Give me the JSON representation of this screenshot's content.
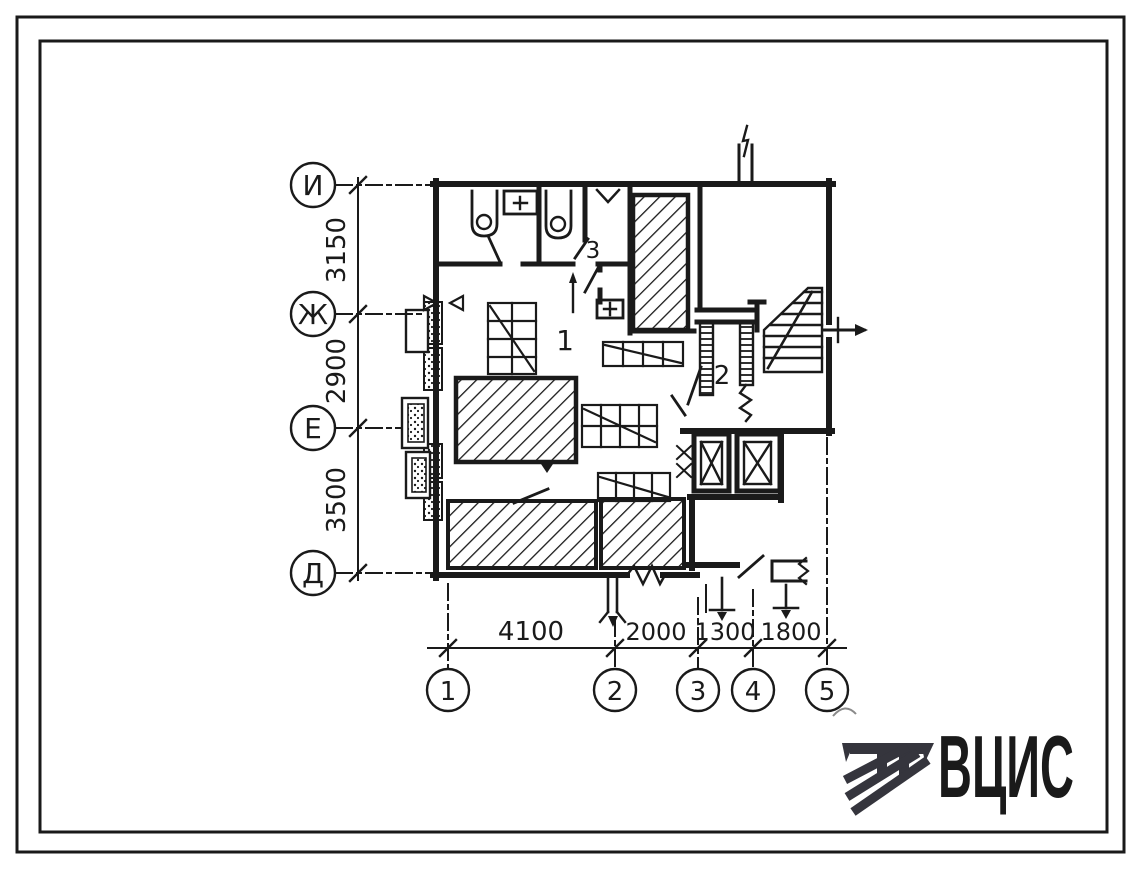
{
  "page": {
    "ink": "#1a1a1a",
    "paper": "#ffffff",
    "logo_color": "#35353d"
  },
  "axes": {
    "rows": [
      {
        "label": "И"
      },
      {
        "label": "Ж"
      },
      {
        "label": "Е"
      },
      {
        "label": "Д"
      }
    ],
    "row_dims": [
      "3150",
      "2900",
      "3500"
    ],
    "cols": [
      {
        "label": "1"
      },
      {
        "label": "2"
      },
      {
        "label": "3"
      },
      {
        "label": "4"
      },
      {
        "label": "5"
      }
    ],
    "col_dims": [
      "4100",
      "2000",
      "1300",
      "1800"
    ]
  },
  "rooms": [
    {
      "number": "1"
    },
    {
      "number": "2"
    },
    {
      "number": "3"
    }
  ],
  "logo": {
    "text": "ВЦИС"
  }
}
